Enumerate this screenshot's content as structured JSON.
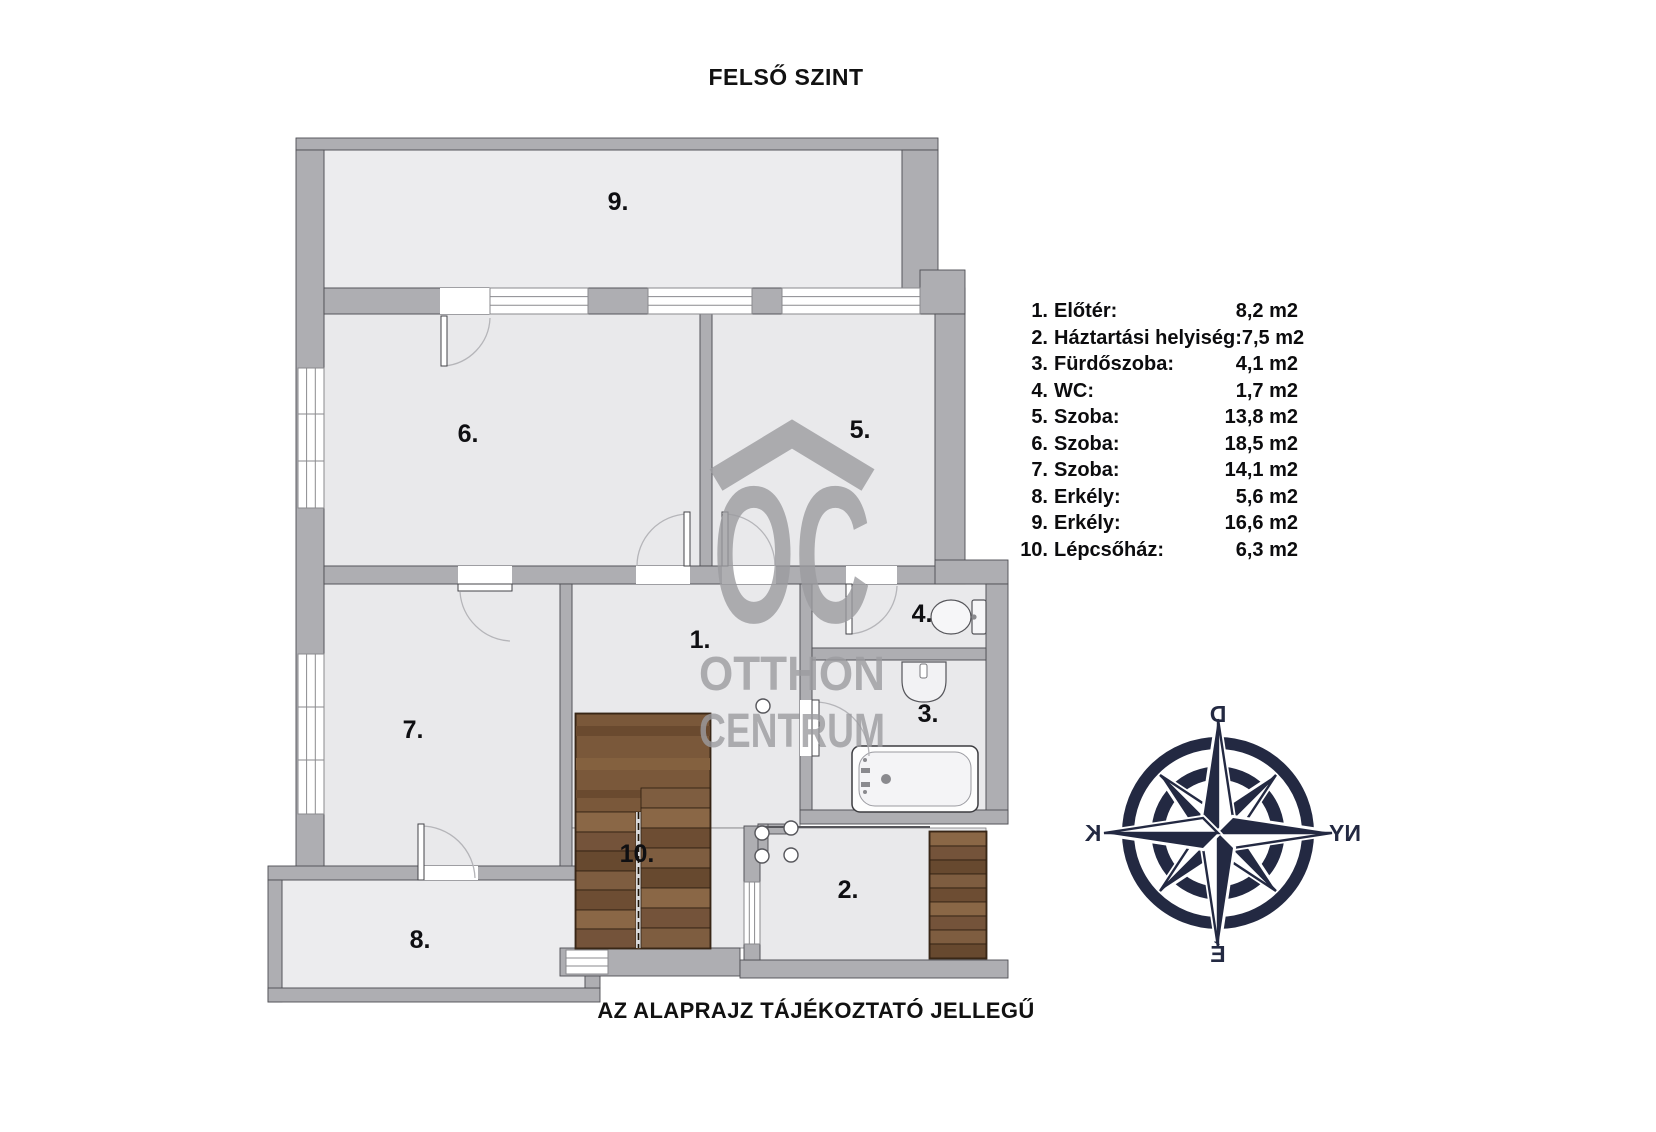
{
  "title": "FELSŐ SZINT",
  "footer_note": "AZ ALAPRAJZ TÁJÉKOZTATÓ JELLEGŰ",
  "watermark": {
    "logo": "OC",
    "line1": "OTTHON",
    "line2": "CENTRUM"
  },
  "compass": {
    "top": "D",
    "left": "K",
    "right": "NY",
    "bottom": "É"
  },
  "plan": {
    "rooms": [
      {
        "id": 1,
        "label": "1."
      },
      {
        "id": 2,
        "label": "2."
      },
      {
        "id": 3,
        "label": "3."
      },
      {
        "id": 4,
        "label": "4."
      },
      {
        "id": 5,
        "label": "5."
      },
      {
        "id": 6,
        "label": "6."
      },
      {
        "id": 7,
        "label": "7."
      },
      {
        "id": 8,
        "label": "8."
      },
      {
        "id": 9,
        "label": "9."
      },
      {
        "id": 10,
        "label": "10."
      }
    ]
  },
  "legend": {
    "items": [
      {
        "num": "1.",
        "label": "Előtér:",
        "area": "8,2 m2"
      },
      {
        "num": "2.",
        "label": "Háztartási helyiség:",
        "area": "7,5 m2"
      },
      {
        "num": "3.",
        "label": "Fürdőszoba:",
        "area": "4,1 m2"
      },
      {
        "num": "4.",
        "label": "WC:",
        "area": "1,7 m2"
      },
      {
        "num": "5.",
        "label": "Szoba:",
        "area": "13,8 m2"
      },
      {
        "num": "6.",
        "label": "Szoba:",
        "area": "18,5 m2"
      },
      {
        "num": "7.",
        "label": "Szoba:",
        "area": "14,1 m2"
      },
      {
        "num": "8.",
        "label": "Erkély:",
        "area": "5,6 m2"
      },
      {
        "num": "9.",
        "label": "Erkély:",
        "area": "16,6 m2"
      },
      {
        "num": "10.",
        "label": "Lépcsőház:",
        "area": "6,3 m2"
      }
    ]
  },
  "colors": {
    "wall": "#aeaeb2",
    "floor": "#e9e9eb",
    "stair_wood": "#7d5c3e",
    "compass_navy": "#232942",
    "watermark_gray": "#9c9ca0"
  }
}
